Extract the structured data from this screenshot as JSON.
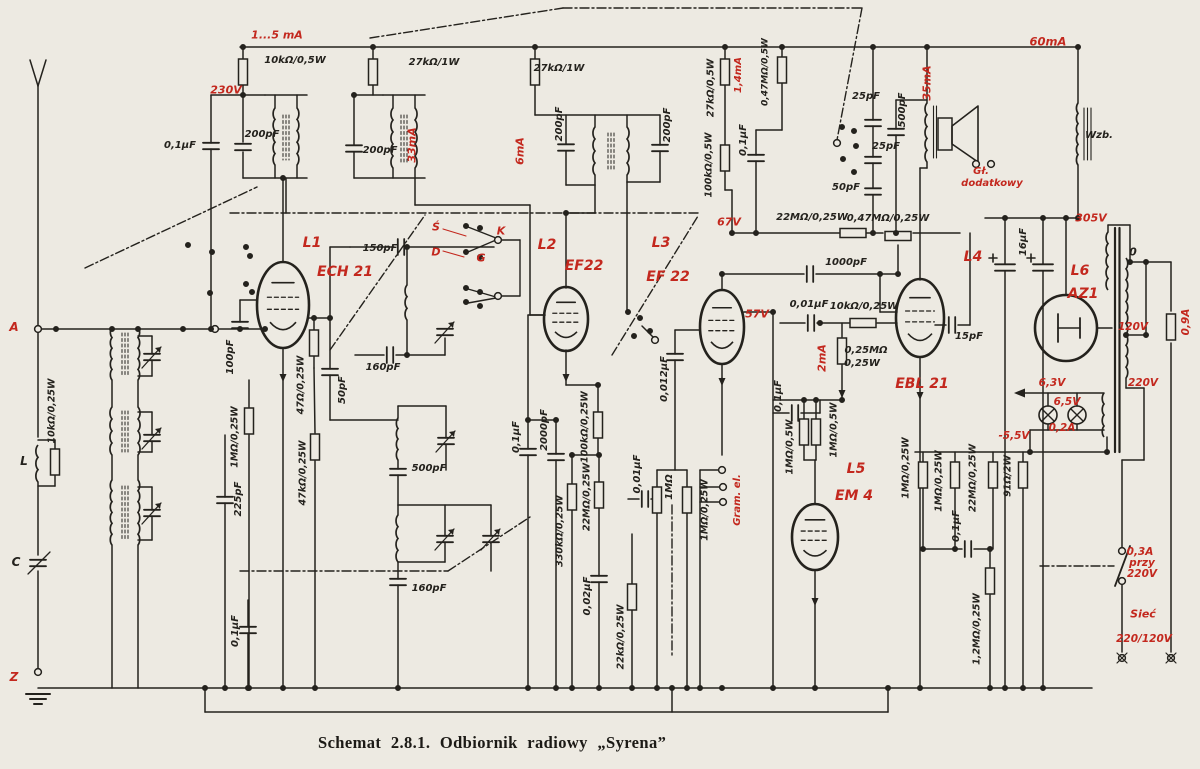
{
  "figure": {
    "caption": "Schemat 2.8.1. Odbiornik radiowy „Syrena”"
  },
  "colors": {
    "paper": "#edeae2",
    "ink": "#24221d",
    "red": "#c3281e"
  },
  "tube_lineup": [
    "L1 ECH 21",
    "L2 EF22",
    "L3 EF 22",
    "L4 EBL 21",
    "L5 EM 4",
    "L6 AZ1"
  ],
  "labels": [
    {
      "t": "1...5 mA",
      "x": 277,
      "y": 35,
      "c": "r",
      "s": 11
    },
    {
      "t": "230V",
      "x": 226,
      "y": 90,
      "c": "r",
      "s": 11
    },
    {
      "t": "33mA",
      "x": 412,
      "y": 145,
      "r": -90,
      "c": "r",
      "s": 11
    },
    {
      "t": "6mA",
      "x": 520,
      "y": 151,
      "r": -90,
      "c": "r",
      "s": 11
    },
    {
      "t": "1,4mA",
      "x": 739,
      "y": 75,
      "r": -90,
      "c": "r",
      "s": 10
    },
    {
      "t": "35mA",
      "x": 927,
      "y": 83,
      "r": -90,
      "c": "r",
      "s": 11
    },
    {
      "t": "60mA",
      "x": 1048,
      "y": 42,
      "c": "r",
      "s": 11.5
    },
    {
      "t": "67V",
      "x": 729,
      "y": 222,
      "c": "r",
      "s": 11
    },
    {
      "t": "57V",
      "x": 757,
      "y": 314,
      "c": "r",
      "s": 11
    },
    {
      "t": "305V",
      "x": 1091,
      "y": 218,
      "c": "r",
      "s": 11
    },
    {
      "t": "Gł.",
      "x": 981,
      "y": 172,
      "c": "r",
      "s": 10
    },
    {
      "t": "dodatkowy",
      "x": 992,
      "y": 184,
      "c": "r",
      "s": 10
    },
    {
      "t": "L1",
      "x": 312,
      "y": 243,
      "c": "r",
      "s": 14,
      "w": 700
    },
    {
      "t": "ECH 21",
      "x": 345,
      "y": 272,
      "c": "r",
      "s": 14,
      "w": 700
    },
    {
      "t": "L2",
      "x": 547,
      "y": 245,
      "c": "r",
      "s": 14,
      "w": 700
    },
    {
      "t": "EF22",
      "x": 584,
      "y": 266,
      "c": "r",
      "s": 14,
      "w": 700
    },
    {
      "t": "L3",
      "x": 661,
      "y": 243,
      "c": "r",
      "s": 14,
      "w": 700
    },
    {
      "t": "EF 22",
      "x": 668,
      "y": 277,
      "c": "r",
      "s": 14,
      "w": 700
    },
    {
      "t": "L4",
      "x": 973,
      "y": 257,
      "c": "r",
      "s": 14,
      "w": 700
    },
    {
      "t": "EBL 21",
      "x": 922,
      "y": 384,
      "c": "r",
      "s": 14,
      "w": 700
    },
    {
      "t": "L5",
      "x": 856,
      "y": 469,
      "c": "r",
      "s": 14,
      "w": 700
    },
    {
      "t": "EM 4",
      "x": 854,
      "y": 496,
      "c": "r",
      "s": 14,
      "w": 700
    },
    {
      "t": "L6",
      "x": 1080,
      "y": 271,
      "c": "r",
      "s": 14,
      "w": 700
    },
    {
      "t": "AZ1",
      "x": 1083,
      "y": 294,
      "c": "r",
      "s": 14,
      "w": 700
    },
    {
      "t": "Ś",
      "x": 436,
      "y": 227,
      "c": "r",
      "s": 11,
      "w": 700
    },
    {
      "t": "K",
      "x": 501,
      "y": 231,
      "c": "r",
      "s": 11,
      "w": 700
    },
    {
      "t": "D",
      "x": 436,
      "y": 252,
      "c": "r",
      "s": 11,
      "w": 700
    },
    {
      "t": "G",
      "x": 481,
      "y": 258,
      "c": "r",
      "s": 11,
      "w": 700
    },
    {
      "t": "2mA",
      "x": 822,
      "y": 358,
      "r": -90,
      "c": "r",
      "s": 11
    },
    {
      "t": "6,3V",
      "x": 1052,
      "y": 383,
      "c": "r",
      "s": 10.5
    },
    {
      "t": "6,5V",
      "x": 1067,
      "y": 402,
      "c": "r",
      "s": 10.5
    },
    {
      "t": "0,2A",
      "x": 1062,
      "y": 428,
      "c": "r",
      "s": 10.5
    },
    {
      "t": "-5,5V",
      "x": 1014,
      "y": 436,
      "c": "r",
      "s": 10.5
    },
    {
      "t": "220V",
      "x": 1143,
      "y": 383,
      "c": "r",
      "s": 10.5
    },
    {
      "t": "120V",
      "x": 1133,
      "y": 327,
      "c": "r",
      "s": 10.5
    },
    {
      "t": "0,9A",
      "x": 1186,
      "y": 322,
      "r": -90,
      "c": "r",
      "s": 10.5
    },
    {
      "t": "0,3A",
      "x": 1140,
      "y": 552,
      "c": "r",
      "s": 10.5
    },
    {
      "t": "przy",
      "x": 1142,
      "y": 563,
      "c": "r",
      "s": 10.5
    },
    {
      "t": "220V",
      "x": 1142,
      "y": 574,
      "c": "r",
      "s": 10.5
    },
    {
      "t": "Sieć",
      "x": 1143,
      "y": 614,
      "c": "r",
      "s": 11,
      "w": 700
    },
    {
      "t": "220/120V",
      "x": 1144,
      "y": 639,
      "c": "r",
      "s": 10.5
    },
    {
      "t": "A",
      "x": 14,
      "y": 327,
      "c": "r",
      "s": 12,
      "w": 700
    },
    {
      "t": "Z",
      "x": 14,
      "y": 677,
      "c": "r",
      "s": 12,
      "w": 700
    },
    {
      "t": "Gram. el.",
      "x": 738,
      "y": 500,
      "r": -90,
      "c": "r",
      "s": 10
    },
    {
      "t": "10kΩ/0,5W",
      "x": 295,
      "y": 61
    },
    {
      "t": "0,1μF",
      "x": 180,
      "y": 146
    },
    {
      "t": "200pF",
      "x": 262,
      "y": 135
    },
    {
      "t": "200pF",
      "x": 380,
      "y": 151
    },
    {
      "t": "27kΩ/1W",
      "x": 434,
      "y": 63
    },
    {
      "t": "27kΩ/1W",
      "x": 559,
      "y": 69
    },
    {
      "t": "200pF",
      "x": 560,
      "y": 124,
      "r": -90
    },
    {
      "t": "200pF",
      "x": 668,
      "y": 125,
      "r": -90
    },
    {
      "t": "27kΩ/0,5W",
      "x": 711,
      "y": 88,
      "r": -90,
      "s": 9.5
    },
    {
      "t": "0,47MΩ/0,5W",
      "x": 766,
      "y": 72,
      "r": -90,
      "s": 9
    },
    {
      "t": "100kΩ/0,5W",
      "x": 709,
      "y": 165,
      "r": -90,
      "s": 9.5
    },
    {
      "t": "0,1μF",
      "x": 744,
      "y": 140,
      "r": -90
    },
    {
      "t": "25pF",
      "x": 866,
      "y": 97
    },
    {
      "t": "25pF",
      "x": 886,
      "y": 147
    },
    {
      "t": "50pF",
      "x": 846,
      "y": 188
    },
    {
      "t": "500pF",
      "x": 903,
      "y": 110,
      "r": -90
    },
    {
      "t": "Wzb.",
      "x": 1099,
      "y": 136
    },
    {
      "t": "22MΩ/0,25W",
      "x": 812,
      "y": 218
    },
    {
      "t": "0,47MΩ/0,25W",
      "x": 888,
      "y": 219
    },
    {
      "t": "1000pF",
      "x": 846,
      "y": 263
    },
    {
      "t": "0,01μF",
      "x": 809,
      "y": 305
    },
    {
      "t": "10kΩ/0,25W",
      "x": 864,
      "y": 307
    },
    {
      "t": "0,25MΩ",
      "x": 866,
      "y": 351
    },
    {
      "t": "0,25W",
      "x": 862,
      "y": 364
    },
    {
      "t": "15pF",
      "x": 969,
      "y": 337
    },
    {
      "t": "150pF",
      "x": 380,
      "y": 249
    },
    {
      "t": "160pF",
      "x": 383,
      "y": 368
    },
    {
      "t": "50pF",
      "x": 343,
      "y": 390,
      "r": -90
    },
    {
      "t": "47Ω/0,25W",
      "x": 301,
      "y": 385,
      "r": -90,
      "s": 9.5
    },
    {
      "t": "47kΩ/0,25W",
      "x": 303,
      "y": 473,
      "r": -90,
      "s": 9.5
    },
    {
      "t": "1MΩ/0,25W",
      "x": 235,
      "y": 437,
      "r": -90,
      "s": 9.5
    },
    {
      "t": "100pF",
      "x": 231,
      "y": 357,
      "r": -90
    },
    {
      "t": "225pF",
      "x": 239,
      "y": 499,
      "r": -90
    },
    {
      "t": "0,1μF",
      "x": 236,
      "y": 631,
      "r": -90
    },
    {
      "t": "10kΩ/0,25W",
      "x": 52,
      "y": 411,
      "r": -90,
      "s": 9.5
    },
    {
      "t": "L",
      "x": 24,
      "y": 461,
      "s": 12,
      "w": 700
    },
    {
      "t": "C",
      "x": 16,
      "y": 562,
      "s": 12,
      "w": 700
    },
    {
      "t": "500pF",
      "x": 429,
      "y": 469
    },
    {
      "t": "160pF",
      "x": 429,
      "y": 589
    },
    {
      "t": "0,1μF",
      "x": 517,
      "y": 437,
      "r": -90
    },
    {
      "t": "2000pF",
      "x": 545,
      "y": 430,
      "r": -90
    },
    {
      "t": "100kΩ/0,25W",
      "x": 585,
      "y": 427,
      "r": -90,
      "s": 9.5
    },
    {
      "t": "22MΩ/0,25W",
      "x": 587,
      "y": 497,
      "r": -90,
      "s": 9.5
    },
    {
      "t": "330kΩ/0,25W",
      "x": 560,
      "y": 531,
      "r": -90,
      "s": 9.5
    },
    {
      "t": "0,02μF",
      "x": 588,
      "y": 596,
      "r": -90
    },
    {
      "t": "22kΩ/0,25W",
      "x": 621,
      "y": 637,
      "r": -90,
      "s": 9.5
    },
    {
      "t": "0,012μF",
      "x": 665,
      "y": 379,
      "r": -90
    },
    {
      "t": "0,01μF",
      "x": 638,
      "y": 474,
      "r": -90
    },
    {
      "t": "1MΩ",
      "x": 670,
      "y": 487,
      "r": -90
    },
    {
      "t": "1MΩ/0,25W",
      "x": 705,
      "y": 510,
      "r": -90,
      "s": 9.5
    },
    {
      "t": "0,1μF",
      "x": 779,
      "y": 396,
      "r": -90
    },
    {
      "t": "1MΩ/0,5W",
      "x": 790,
      "y": 447,
      "r": -90,
      "s": 9.5
    },
    {
      "t": "1MΩ/0,5W",
      "x": 834,
      "y": 430,
      "r": -90,
      "s": 9.5
    },
    {
      "t": "1MΩ/0,25W",
      "x": 906,
      "y": 468,
      "r": -90,
      "s": 9.5
    },
    {
      "t": "1MΩ/0,25W",
      "x": 939,
      "y": 481,
      "r": -90,
      "s": 9.5
    },
    {
      "t": "22MΩ/0,25W",
      "x": 973,
      "y": 478,
      "r": -90,
      "s": 9.5
    },
    {
      "t": "91Ω/2W",
      "x": 1008,
      "y": 476,
      "r": -90,
      "s": 9.5
    },
    {
      "t": "0,1μF",
      "x": 957,
      "y": 526,
      "r": -90
    },
    {
      "t": "1,2MΩ/0,25W",
      "x": 977,
      "y": 629,
      "r": -90,
      "s": 9.5
    },
    {
      "t": "16μF",
      "x": 1024,
      "y": 242,
      "r": -90
    },
    {
      "t": "0",
      "x": 1133,
      "y": 252,
      "s": 11
    }
  ]
}
